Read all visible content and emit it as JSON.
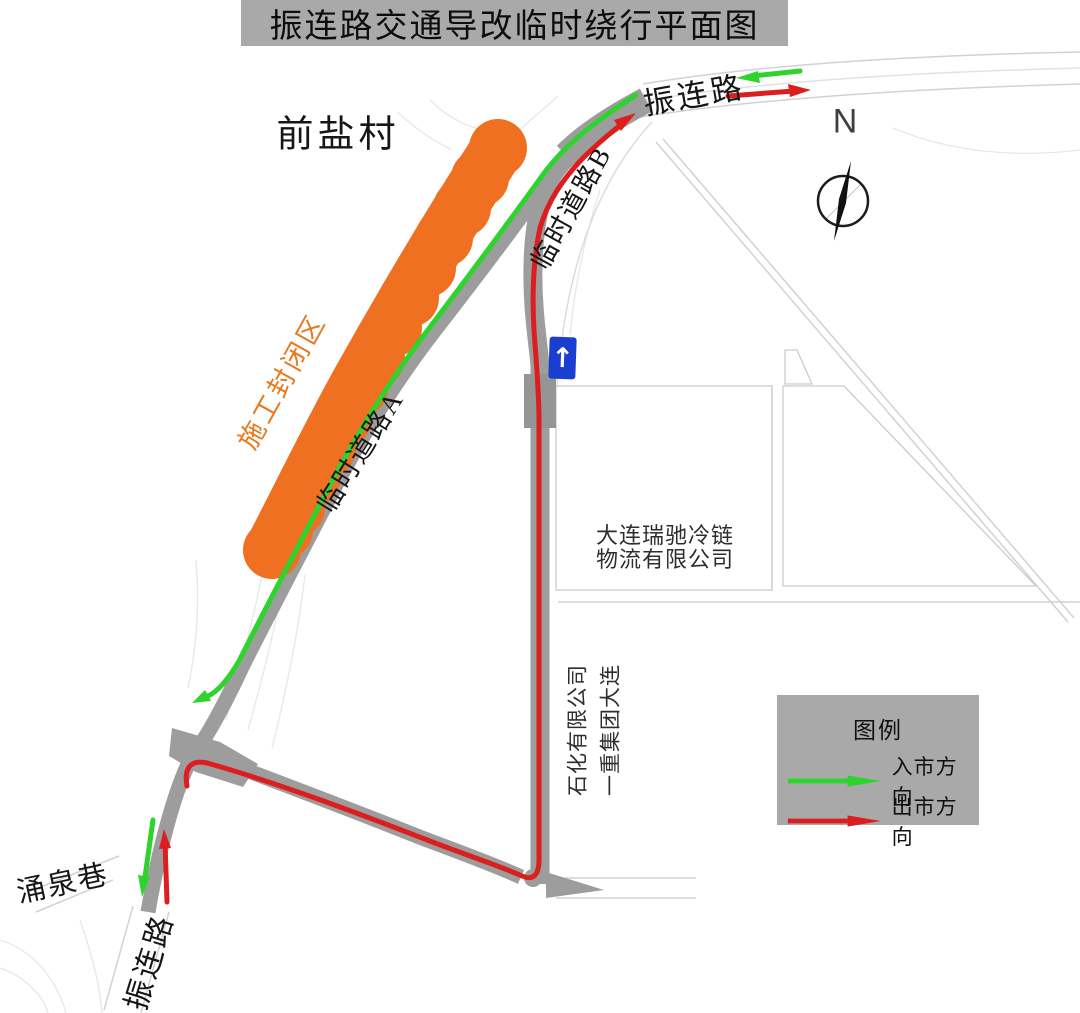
{
  "title": "振连路交通导改临时绕行平面图",
  "colors": {
    "inbound_green": "#2ed32e",
    "outbound_red": "#dd1e1e",
    "construction_orange": "#ee7020",
    "road_gray": "#9d9d9d",
    "road_gray_dark": "#959595",
    "panel_gray": "#a9a9a9",
    "sign_blue": "#1a3fd0"
  },
  "labels": {
    "village": "前盐村",
    "construction_zone": "施工封闭区",
    "temp_road_a": "临时道路A",
    "temp_road_b": "临时道路B",
    "zhenlian_road_ne": "振连路",
    "zhenlian_road_sw": "振连路",
    "yongquan_lane": "涌泉巷",
    "company_coldchain_line1": "大连瑞驰冷链",
    "company_coldchain_line2": "物流有限公司",
    "company_petrochem_line1": "一重集团大连",
    "company_petrochem_line2": "石化有限公司",
    "north": "N",
    "one_way_arrow": "↑"
  },
  "legend": {
    "title": "图例",
    "items": [
      {
        "label": "入市方向",
        "color": "#2ed32e"
      },
      {
        "label": "出市方向",
        "color": "#dd1e1e"
      }
    ]
  }
}
